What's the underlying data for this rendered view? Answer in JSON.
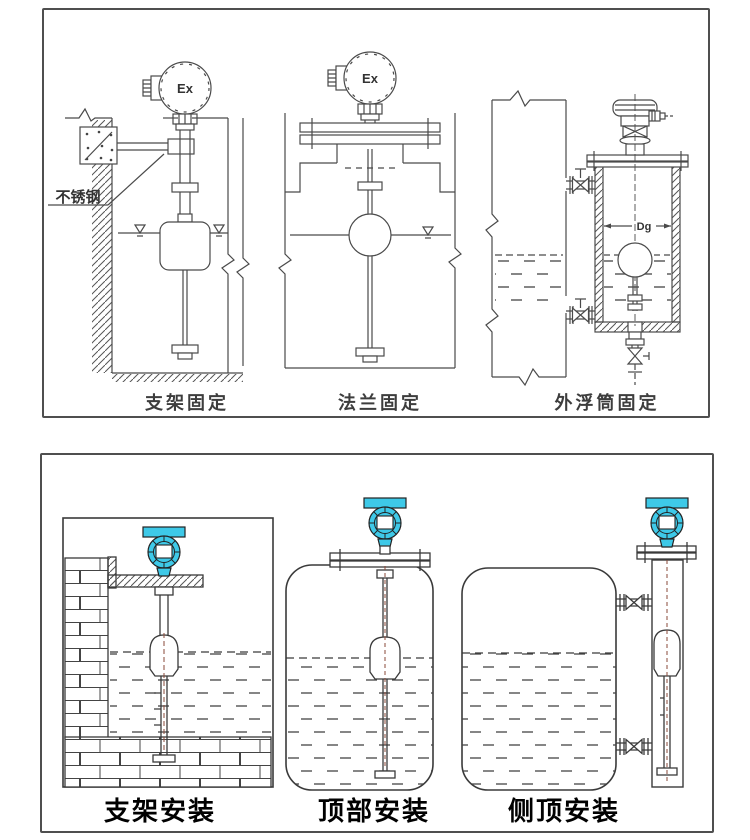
{
  "colors": {
    "line": "#4a4a4a",
    "transmitter_fill": "#3ec9e8",
    "center_dash": "#8a4a3a",
    "caption": "#3d3d3d",
    "caption_bold": "#000000",
    "panel_border": "#4f4f4f"
  },
  "top_panel": {
    "labels": {
      "stainless_steel": "不锈钢",
      "ex_mark_1": "Ex",
      "ex_mark_2": "Ex",
      "dg_mark": "Dg"
    },
    "captions": [
      {
        "text": "支架固定"
      },
      {
        "text": "法兰固定"
      },
      {
        "text": "外浮筒固定"
      }
    ]
  },
  "bottom_panel": {
    "captions": [
      {
        "text": "支架安装"
      },
      {
        "text": "顶部安装"
      },
      {
        "text": "侧顶安装"
      }
    ]
  }
}
